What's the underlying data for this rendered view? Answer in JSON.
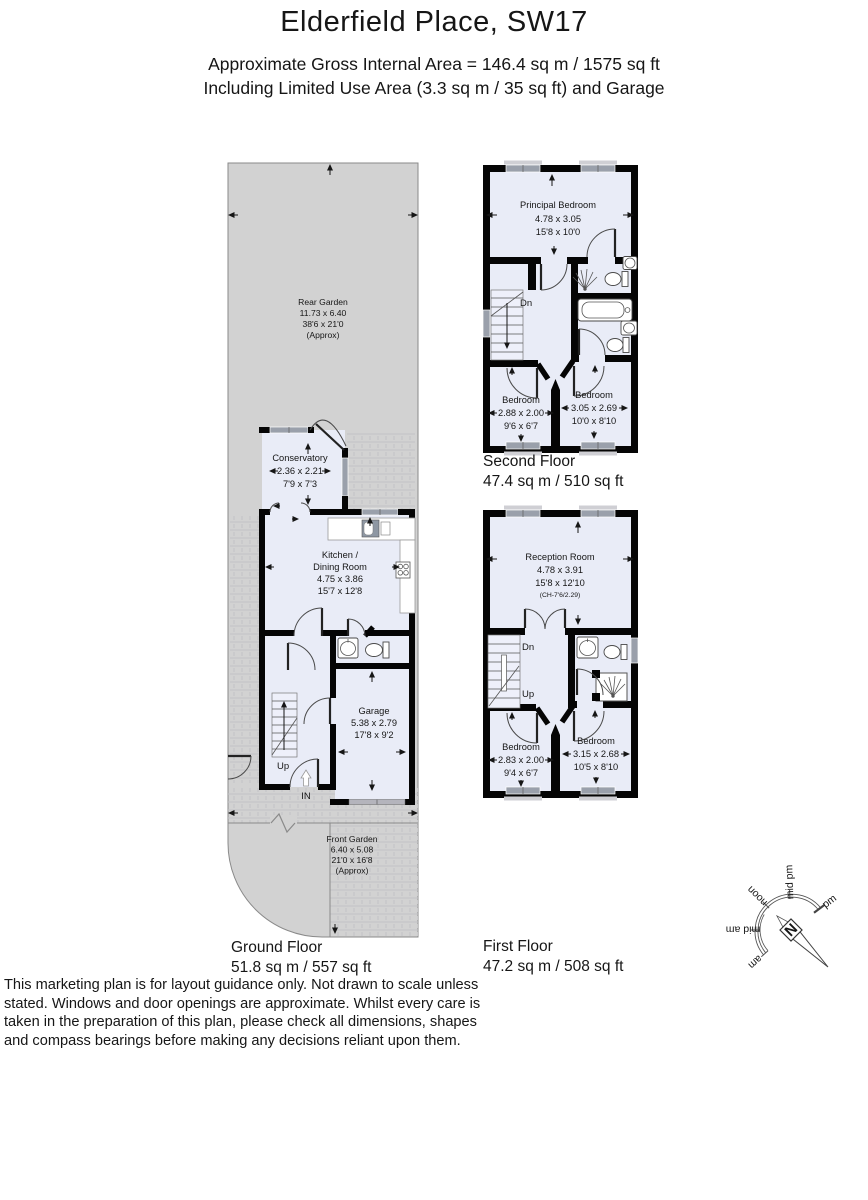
{
  "header": {
    "title": "Elderfield Place, SW17",
    "subtitle_line1": "Approximate Gross Internal Area = 146.4 sq m / 1575 sq ft",
    "subtitle_line2": "Including Limited Use Area (3.3 sq m / 35 sq ft) and Garage"
  },
  "labels": {
    "up": "Up",
    "down": "Dn",
    "entrance": "IN",
    "north": "N"
  },
  "ground_floor": {
    "floor_label": "Ground Floor",
    "floor_area": "51.8 sq m / 557 sq ft",
    "rear_garden": {
      "name": "Rear Garden",
      "metric": "11.73 x 6.40",
      "imperial": "38'6 x 21'0",
      "approx": "(Approx)"
    },
    "conservatory": {
      "name": "Conservatory",
      "metric": "2.36 x 2.21",
      "imperial": "7'9 x 7'3"
    },
    "kitchen_dining": {
      "name_line1": "Kitchen /",
      "name_line2": "Dining Room",
      "metric": "4.75 x 3.86",
      "imperial": "15'7 x 12'8"
    },
    "garage": {
      "name": "Garage",
      "metric": "5.38 x 2.79",
      "imperial": "17'8 x 9'2"
    },
    "front_garden": {
      "name": "Front Garden",
      "metric": "6.40 x 5.08",
      "imperial": "21'0 x 16'8",
      "approx": "(Approx)"
    }
  },
  "first_floor": {
    "floor_label": "First Floor",
    "floor_area": "47.2 sq m / 508 sq ft",
    "reception": {
      "name": "Reception Room",
      "metric": "4.78 x 3.91",
      "imperial": "15'8 x 12'10",
      "ceiling_height": "(CH-7'6/2.29)"
    },
    "bedroom_left": {
      "name": "Bedroom",
      "metric": "2.83 x 2.00",
      "imperial": "9'4 x 6'7"
    },
    "bedroom_right": {
      "name": "Bedroom",
      "metric": "3.15 x 2.68",
      "imperial": "10'5 x 8'10"
    }
  },
  "second_floor": {
    "floor_label": "Second Floor",
    "floor_area": "47.4 sq m / 510 sq ft",
    "principal_bedroom": {
      "name": "Principal Bedroom",
      "metric": "4.78 x 3.05",
      "imperial": "15'8 x 10'0"
    },
    "bedroom_left": {
      "name": "Bedroom",
      "metric": "2.88 x 2.00",
      "imperial": "9'6 x 6'7"
    },
    "bedroom_right": {
      "name": "Bedroom",
      "metric": "3.05 x 2.69",
      "imperial": "10'0 x 8'10"
    }
  },
  "compass": {
    "time_labels": [
      "am",
      "mid am",
      "noon",
      "mid pm",
      "pm"
    ]
  },
  "disclaimer_lines": [
    "This marketing plan is for layout guidance only. Not drawn to scale unless",
    "stated. Windows and door openings are approximate. Whilst every care is",
    "taken in the preparation of this plan, please check all dimensions, shapes",
    "and compass bearings before making any decisions reliant upon them."
  ],
  "colors": {
    "room_fill": "#e9ecf7",
    "garden_fill": "#d2d2d2",
    "wall": "#050505",
    "window": "#9aa0ab"
  }
}
